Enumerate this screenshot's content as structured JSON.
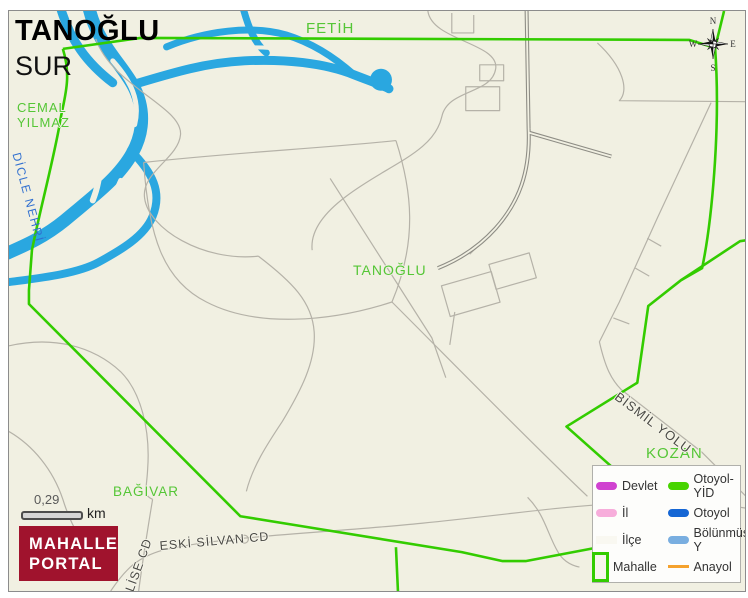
{
  "header": {
    "district_title": "TANOĞLU",
    "parent_title": "SUR"
  },
  "map": {
    "area_labels": {
      "fetih": "FETİH",
      "cemal_line1": "CEMAL",
      "cemal_line2": "YILMAZ",
      "tanoglu": "TANOĞLU",
      "kozan": "KOZAN",
      "bagivar": "BAĞIVAR"
    },
    "river_label": "DİCLE NEHRİ",
    "road_labels": {
      "bismil": "BİSMİL YOLU",
      "eski_silvan": "ESKİ SİLVAN CD",
      "lise": "LİSE CD"
    }
  },
  "scalebar": {
    "value": "0,29",
    "unit": "km"
  },
  "logo": {
    "line1": "MAHALLE",
    "line2": "PORTAL"
  },
  "compass": {
    "n": "N",
    "e": "E",
    "s": "S",
    "w": "W"
  },
  "legend": {
    "left": [
      {
        "label": "Devlet",
        "color": "#d042d0"
      },
      {
        "label": "İl",
        "color": "#f7addb"
      },
      {
        "label": "İlçe",
        "color": "#f9f8f1"
      },
      {
        "label": "Mahalle",
        "color": "#33cc00"
      }
    ],
    "right": [
      {
        "label": "Otoyol-YİD",
        "color": "#47d400"
      },
      {
        "label": "Otoyol",
        "color": "#1566d4"
      },
      {
        "label": "Bölünmüş Y",
        "color": "#79aee0"
      },
      {
        "label": "Anayol",
        "color": "#f5a22d"
      }
    ]
  },
  "colors": {
    "map_bg": "#f1f0e2",
    "river": "#2aa7e0",
    "boundary_green": "#33cc00",
    "label_green": "#55c636",
    "road_gray": "#b5b2a8",
    "railway_gray": "#8e8d85",
    "river_label_blue": "#2f6fd0",
    "road_label_gray": "#4a4a45",
    "logo_bg": "#a0132d"
  }
}
